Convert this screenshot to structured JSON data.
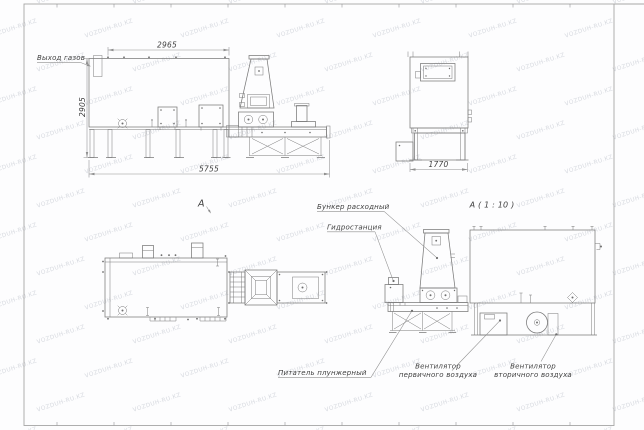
{
  "watermark": {
    "text": "VOZDUH-RU.KZ"
  },
  "labels": {
    "gas_outlet": "Выход газов",
    "view_marker": "А",
    "section_title": "А ( 1 : 10 )",
    "hopper": "Бункер расходный",
    "hydraulic_station": "Гидростанция",
    "plunger_feeder": "Питатель плунжерный",
    "primary_fan_line1": "Вентилятор",
    "primary_fan_line2": "первичного воздуха",
    "secondary_fan_line1": "Вентилятор",
    "secondary_fan_line2": "вторичного воздуха"
  },
  "dimensions": {
    "front_width": "2965",
    "front_height": "2905",
    "overall_length": "5755",
    "end_width": "1770"
  },
  "colors": {
    "line": "#7a7a7a",
    "dim_line": "#8f8f8f",
    "text": "#3f3f3f",
    "watermark": "#b7bcc6",
    "frame": "#a6a6a6"
  }
}
